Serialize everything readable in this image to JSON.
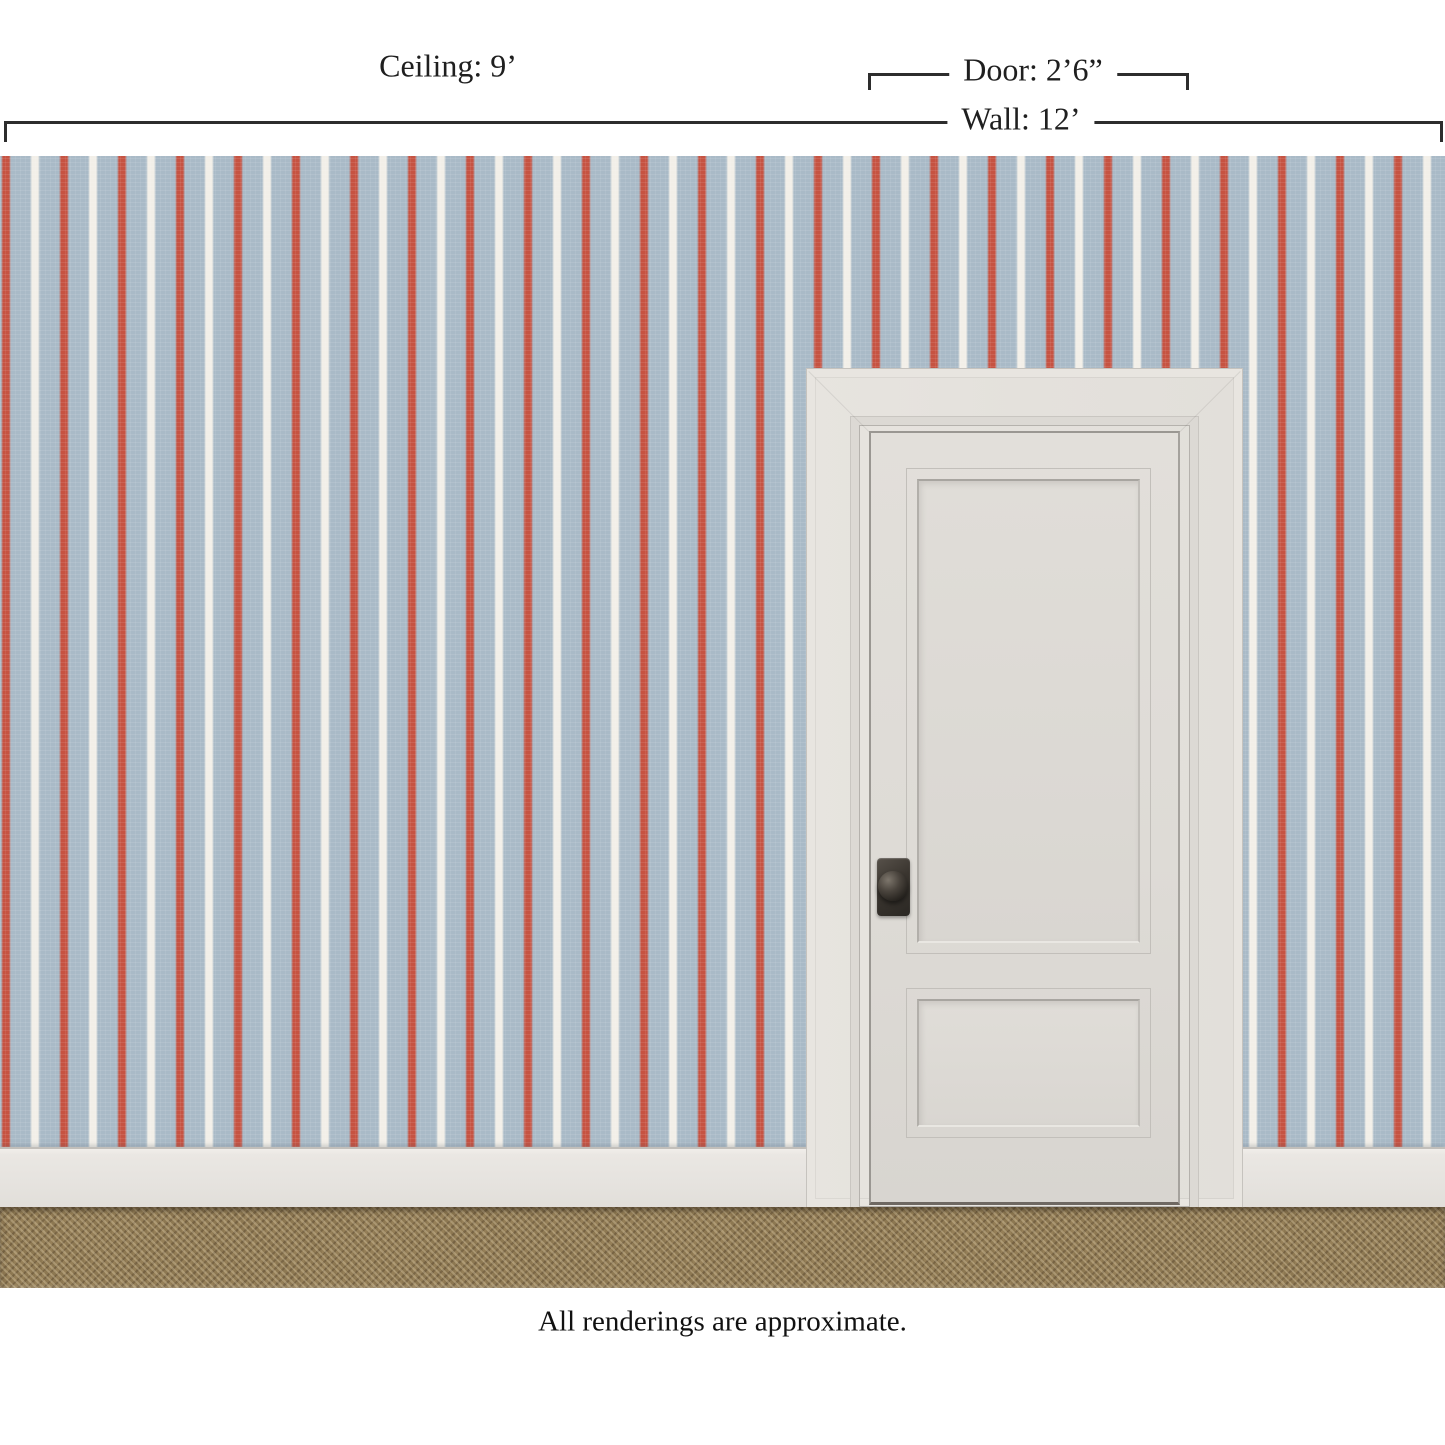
{
  "annotations": {
    "ceiling": "Ceiling: 9’",
    "door": "Door: 2’6”",
    "wall": "Wall: 12’"
  },
  "footnote": "All renderings are approximate.",
  "scene": {
    "wallpaper": {
      "description": "light blue linen-textured wallpaper with hand-drawn vertical red and off-white ticking stripes",
      "ground_color": "#a9bac7",
      "red_stripe_color": "#c65342",
      "white_stripe_color": "#f2efe8",
      "stripe_spacing_px": 58
    },
    "door": {
      "style": "two-panel interior door with casing",
      "paint_color": "#e2dfda",
      "knob_color": "#332f2a"
    },
    "baseboard_color": "#e9e6e2",
    "carpet_color": "#8d7852",
    "dimension_line_color": "#2d2d2d"
  }
}
